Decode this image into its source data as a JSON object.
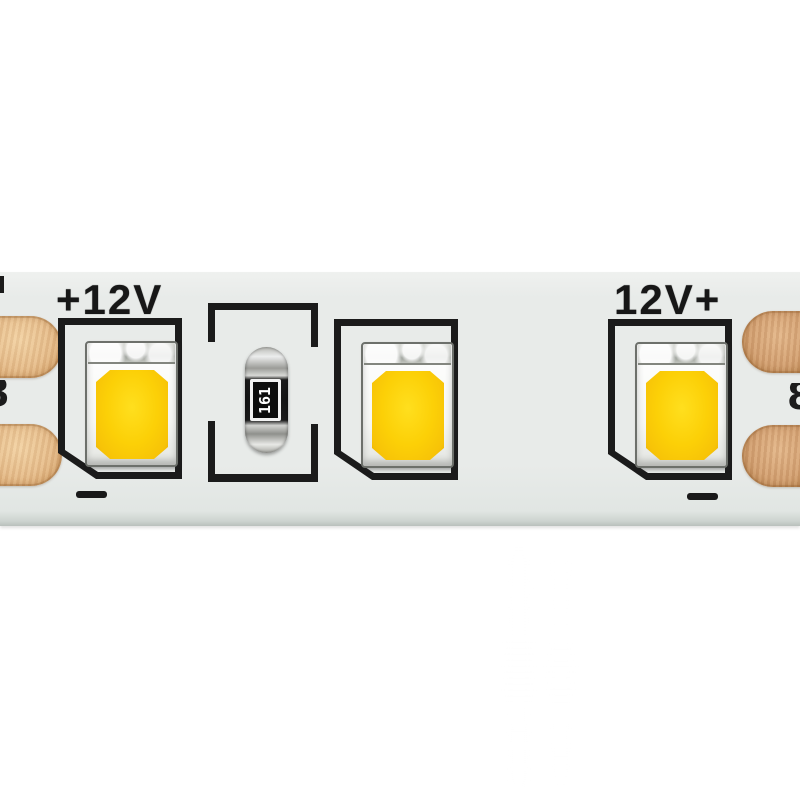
{
  "labels": {
    "left_polarity": "+12V",
    "right_polarity": "12V+",
    "resistor_code": "161",
    "edge_mark_left": "8",
    "edge_mark_right": "8"
  },
  "components": {
    "led_count": 3,
    "resistor_count": 1,
    "solder_pads_left": 2,
    "solder_pads_right": 2,
    "minus_marks": 2
  },
  "colors": {
    "background": "#ffffff",
    "pcb": "#e8ebe9",
    "silkscreen": "#1b1b1b",
    "copper_pad_left": "#ecc79a",
    "copper_pad_right": "#d8ab7e",
    "led_phosphor": "#fcd007",
    "led_body": "#f6f7f4",
    "resistor_body": "#141414",
    "resistor_cap": "#c9cac6",
    "label_ink": "#171717"
  }
}
